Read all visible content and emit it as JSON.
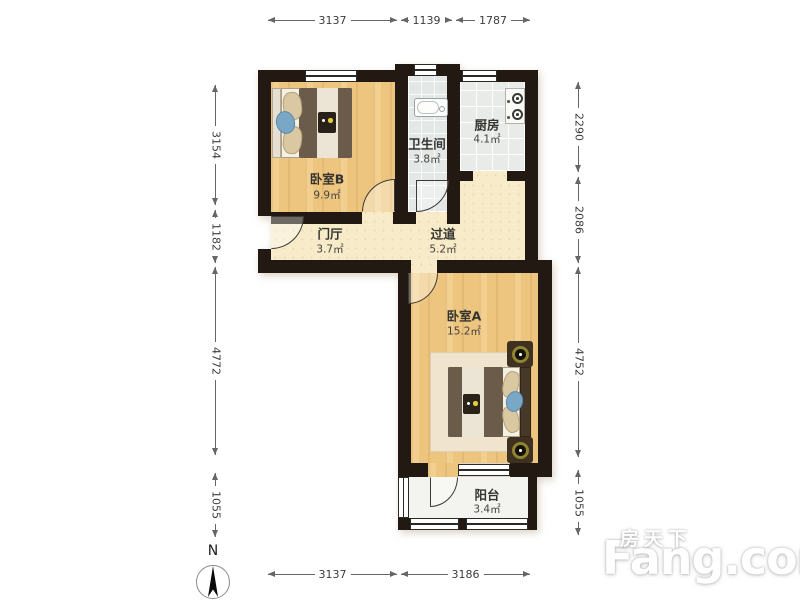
{
  "rooms": {
    "bedroom_b": {
      "name": "卧室B",
      "area": "9.9㎡"
    },
    "bathroom": {
      "name": "卫生间",
      "area": "3.8㎡"
    },
    "kitchen": {
      "name": "厨房",
      "area": "4.1㎡"
    },
    "hall": {
      "name": "门厅",
      "area": "3.7㎡"
    },
    "corridor": {
      "name": "过道",
      "area": "5.2㎡"
    },
    "bedroom_a": {
      "name": "卧室A",
      "area": "15.2㎡"
    },
    "balcony": {
      "name": "阳台",
      "area": "3.4㎡"
    }
  },
  "dimensions_mm": {
    "top": [
      "3137",
      "1139",
      "1787"
    ],
    "bottom": [
      "3137",
      "3186"
    ],
    "left": [
      "3154",
      "1182",
      "4772",
      "1055"
    ],
    "right": [
      "2290",
      "2086",
      "4752",
      "1055"
    ]
  },
  "compass": {
    "label": "N"
  },
  "watermark": {
    "brand_cn": "房天下",
    "brand_en": "Fang.com"
  },
  "colors": {
    "wall": "#221a12",
    "wood_floor": "#eec57f",
    "hall_floor": "#f7ebc9",
    "tile_floor": "#e9ebe9",
    "dimension_line": "#666666",
    "lamp_ring": "#8f842f",
    "cushion_blue": "#7ba7c7"
  }
}
